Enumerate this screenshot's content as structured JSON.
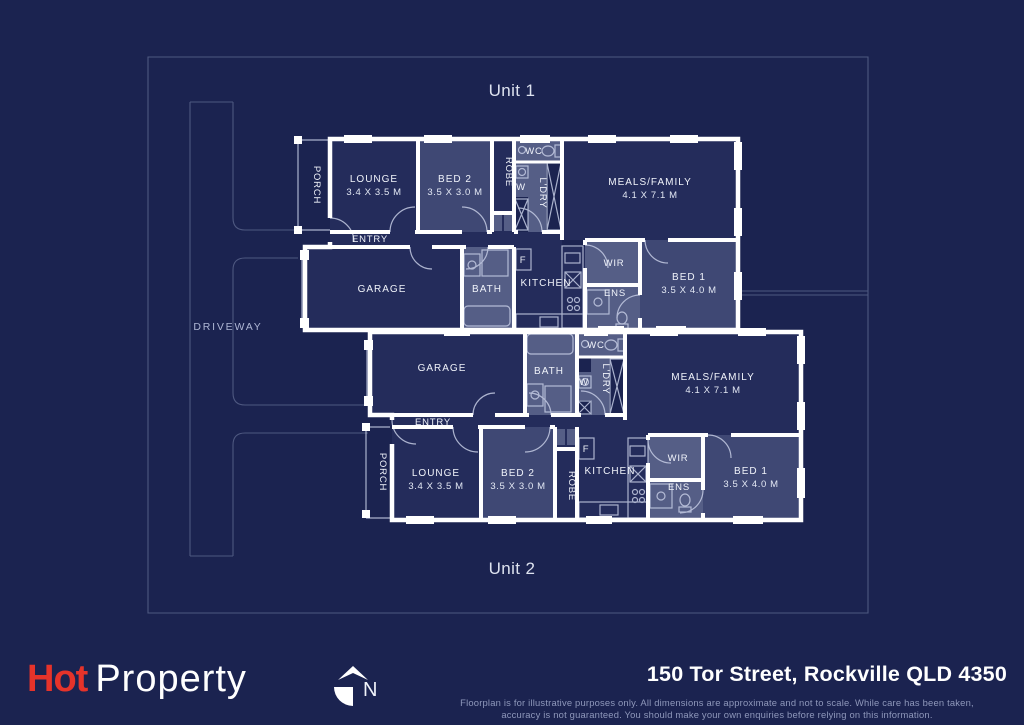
{
  "colors": {
    "background": "#1b2350",
    "wall": "#ffffff",
    "room_fill": "#242c5b",
    "bedroom_fill": "#3f4874",
    "wet_area_fill": "#555e86",
    "boundary_line": "#4e5880",
    "brand_red": "#e6332a",
    "muted_text": "#8f98bb"
  },
  "site": {
    "driveway": "DRIVEWAY"
  },
  "units": [
    {
      "label": "Unit 1",
      "rooms": {
        "porch": "PORCH",
        "lounge": "LOUNGE",
        "lounge_dims": "3.4 X 3.5 M",
        "bed2": "BED 2",
        "bed2_dims": "3.5 X 3.0 M",
        "robe": "ROBE",
        "wc": "WC",
        "washer": "W",
        "ldry": "L'DRY",
        "meals": "MEALS/FAMILY",
        "meals_dims": "4.1 X 7.1 M",
        "entry": "ENTRY",
        "garage": "GARAGE",
        "bath": "BATH",
        "fridge": "F",
        "kitchen": "KITCHEN",
        "wir": "WIR",
        "ens": "ENS",
        "bed1": "BED 1",
        "bed1_dims": "3.5 X 4.0 M"
      }
    },
    {
      "label": "Unit 2",
      "rooms": {
        "porch": "PORCH",
        "lounge": "LOUNGE",
        "lounge_dims": "3.4 X 3.5 M",
        "bed2": "BED 2",
        "bed2_dims": "3.5 X 3.0 M",
        "robe": "ROBE",
        "wc": "WC",
        "washer": "W",
        "ldry": "L'DRY",
        "meals": "MEALS/FAMILY",
        "meals_dims": "4.1 X 7.1 M",
        "entry": "ENTRY",
        "garage": "GARAGE",
        "bath": "BATH",
        "fridge": "F",
        "kitchen": "KITCHEN",
        "wir": "WIR",
        "ens": "ENS",
        "bed1": "BED 1",
        "bed1_dims": "3.5 X 4.0 M"
      }
    }
  ],
  "footer": {
    "brand_hot": "Hot",
    "brand_property": "Property",
    "north": "N",
    "address": "150 Tor Street, Rockville QLD 4350",
    "disclaimer1": "Floorplan is for illustrative purposes only. All dimensions are approximate and not to scale. While care has been taken,",
    "disclaimer2": "accuracy is not guaranteed. You should make your own enquiries before relying on this information."
  }
}
